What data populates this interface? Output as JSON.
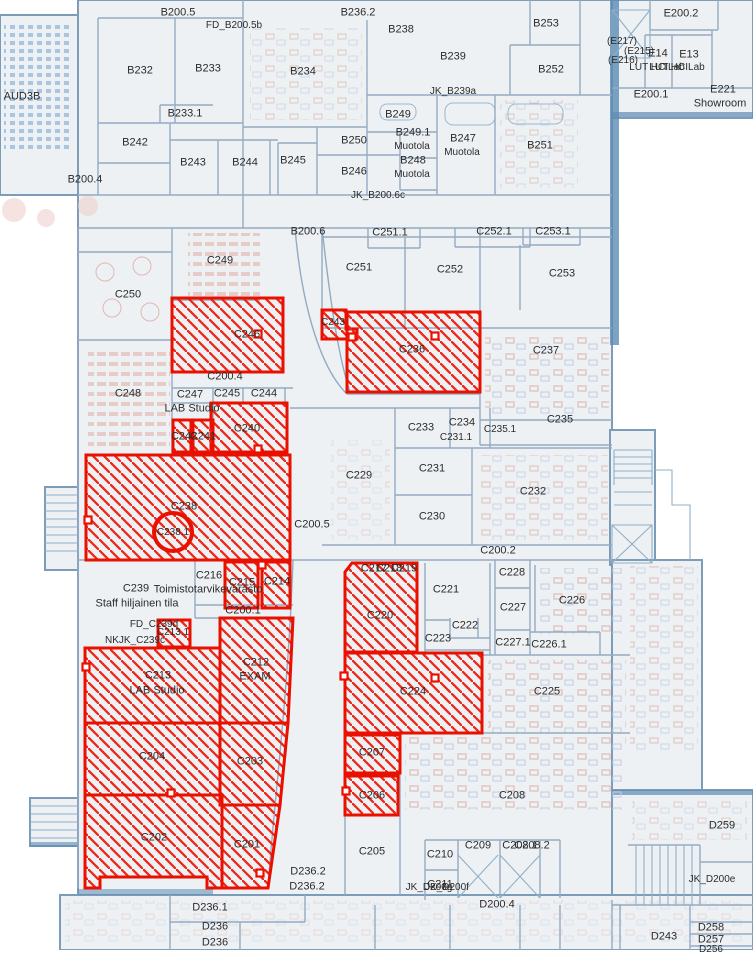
{
  "map": {
    "colors": {
      "highlight": "#ea1000",
      "wall": "#7d9cb8",
      "floor": "#eef1f4",
      "furniture": "#d9b4ae"
    },
    "labels": [
      {
        "t": "B200.5",
        "x": 178,
        "y": 13
      },
      {
        "t": "FD_B200.5b",
        "x": 234,
        "y": 26,
        "s": 10
      },
      {
        "t": "B236.2",
        "x": 358,
        "y": 13
      },
      {
        "t": "E200.2",
        "x": 681,
        "y": 14
      },
      {
        "t": "B232",
        "x": 140,
        "y": 71
      },
      {
        "t": "B233",
        "x": 208,
        "y": 69
      },
      {
        "t": "B234",
        "x": 303,
        "y": 72
      },
      {
        "t": "B238",
        "x": 401,
        "y": 30
      },
      {
        "t": "B239",
        "x": 453,
        "y": 57
      },
      {
        "t": "B253",
        "x": 546,
        "y": 24
      },
      {
        "t": "(E217)",
        "x": 622,
        "y": 42,
        "s": 10
      },
      {
        "t": "(E215)",
        "x": 639,
        "y": 52,
        "s": 10
      },
      {
        "t": "E14",
        "x": 658,
        "y": 54
      },
      {
        "t": "E13",
        "x": 689,
        "y": 55
      },
      {
        "t": "(E216)",
        "x": 623,
        "y": 61,
        "s": 10
      },
      {
        "t": "LUT HCILab",
        "x": 657,
        "y": 68,
        "s": 10
      },
      {
        "t": "LUT HCILab",
        "x": 677,
        "y": 68,
        "s": 10
      },
      {
        "t": "AUD3B",
        "x": 22,
        "y": 97
      },
      {
        "t": "JK_B239a",
        "x": 453,
        "y": 92,
        "s": 10
      },
      {
        "t": "B249",
        "x": 398,
        "y": 115
      },
      {
        "t": "E200.1",
        "x": 651,
        "y": 95
      },
      {
        "t": "E221",
        "x": 723,
        "y": 90
      },
      {
        "t": "Showroom",
        "x": 720,
        "y": 104
      },
      {
        "t": "B233.1",
        "x": 185,
        "y": 114
      },
      {
        "t": "B249.1",
        "x": 413,
        "y": 133
      },
      {
        "t": "Muotola",
        "x": 412,
        "y": 147,
        "s": 10
      },
      {
        "t": "B247",
        "x": 463,
        "y": 139
      },
      {
        "t": "Muotola",
        "x": 462,
        "y": 153,
        "s": 10
      },
      {
        "t": "B252",
        "x": 551,
        "y": 70
      },
      {
        "t": "B242",
        "x": 135,
        "y": 143
      },
      {
        "t": "B250",
        "x": 354,
        "y": 141
      },
      {
        "t": "B251",
        "x": 540,
        "y": 146
      },
      {
        "t": "B243",
        "x": 193,
        "y": 163
      },
      {
        "t": "B244",
        "x": 245,
        "y": 163
      },
      {
        "t": "B245",
        "x": 293,
        "y": 161
      },
      {
        "t": "B248",
        "x": 413,
        "y": 161
      },
      {
        "t": "Muotola",
        "x": 412,
        "y": 175,
        "s": 10
      },
      {
        "t": "B246",
        "x": 354,
        "y": 172
      },
      {
        "t": "B200.4",
        "x": 85,
        "y": 180
      },
      {
        "t": "JK_B200.6c",
        "x": 378,
        "y": 196,
        "s": 10
      },
      {
        "t": "B200.6",
        "x": 308,
        "y": 232
      },
      {
        "t": "C251.1",
        "x": 390,
        "y": 233
      },
      {
        "t": "C252.1",
        "x": 494,
        "y": 232
      },
      {
        "t": "C253.1",
        "x": 553,
        "y": 232
      },
      {
        "t": "C249",
        "x": 220,
        "y": 261
      },
      {
        "t": "C251",
        "x": 359,
        "y": 268
      },
      {
        "t": "C252",
        "x": 450,
        "y": 270
      },
      {
        "t": "C253",
        "x": 562,
        "y": 274
      },
      {
        "t": "C250",
        "x": 128,
        "y": 295
      },
      {
        "t": "C243",
        "x": 333,
        "y": 323,
        "s": 10
      },
      {
        "t": "C246",
        "x": 247,
        "y": 335
      },
      {
        "t": "C236",
        "x": 412,
        "y": 350
      },
      {
        "t": "C237",
        "x": 546,
        "y": 351
      },
      {
        "t": "C200.4",
        "x": 225,
        "y": 377
      },
      {
        "t": "C248",
        "x": 128,
        "y": 394
      },
      {
        "t": "C247",
        "x": 190,
        "y": 395
      },
      {
        "t": "C245",
        "x": 227,
        "y": 394
      },
      {
        "t": "C244",
        "x": 264,
        "y": 394
      },
      {
        "t": "LAB Studio",
        "x": 192,
        "y": 409
      },
      {
        "t": "C240",
        "x": 247,
        "y": 429
      },
      {
        "t": "C242",
        "x": 184,
        "y": 437
      },
      {
        "t": "C241",
        "x": 203,
        "y": 437
      },
      {
        "t": "C233",
        "x": 421,
        "y": 428
      },
      {
        "t": "C234",
        "x": 462,
        "y": 423
      },
      {
        "t": "C231.1",
        "x": 456,
        "y": 438,
        "s": 10
      },
      {
        "t": "C235.1",
        "x": 500,
        "y": 430,
        "s": 10
      },
      {
        "t": "C235",
        "x": 560,
        "y": 420
      },
      {
        "t": "C229",
        "x": 359,
        "y": 476
      },
      {
        "t": "C231",
        "x": 432,
        "y": 469
      },
      {
        "t": "C232",
        "x": 533,
        "y": 492
      },
      {
        "t": "C230",
        "x": 432,
        "y": 517
      },
      {
        "t": "C238",
        "x": 184,
        "y": 507
      },
      {
        "t": "C238.1",
        "x": 173,
        "y": 533,
        "s": 10
      },
      {
        "t": "C200.5",
        "x": 312,
        "y": 525
      },
      {
        "t": "C200.2",
        "x": 498,
        "y": 551
      },
      {
        "t": "C216",
        "x": 209,
        "y": 576
      },
      {
        "t": "C215",
        "x": 242,
        "y": 583
      },
      {
        "t": "C214",
        "x": 277,
        "y": 582
      },
      {
        "t": "C217",
        "x": 374,
        "y": 569
      },
      {
        "t": "C218",
        "x": 389,
        "y": 569
      },
      {
        "t": "C219",
        "x": 404,
        "y": 569
      },
      {
        "t": "C220",
        "x": 380,
        "y": 616
      },
      {
        "t": "C221",
        "x": 446,
        "y": 590
      },
      {
        "t": "C228",
        "x": 512,
        "y": 573
      },
      {
        "t": "C227",
        "x": 513,
        "y": 608
      },
      {
        "t": "C226",
        "x": 572,
        "y": 601
      },
      {
        "t": "C239",
        "x": 136,
        "y": 589
      },
      {
        "t": "Toimistotarvikevarasto",
        "x": 208,
        "y": 590
      },
      {
        "t": "Staff hiljainen tila",
        "x": 137,
        "y": 604
      },
      {
        "t": "C222",
        "x": 465,
        "y": 626
      },
      {
        "t": "C223",
        "x": 438,
        "y": 639
      },
      {
        "t": "C227.1",
        "x": 513,
        "y": 643
      },
      {
        "t": "C226.1",
        "x": 549,
        "y": 645
      },
      {
        "t": "C200.1",
        "x": 243,
        "y": 611
      },
      {
        "t": "FD_C239d",
        "x": 154,
        "y": 625,
        "s": 10
      },
      {
        "t": "C213.1",
        "x": 173,
        "y": 633,
        "s": 10
      },
      {
        "t": "NKJK_C239c",
        "x": 135,
        "y": 641,
        "s": 10
      },
      {
        "t": "C212",
        "x": 256,
        "y": 663
      },
      {
        "t": "EXAM",
        "x": 255,
        "y": 677
      },
      {
        "t": "C213",
        "x": 158,
        "y": 676
      },
      {
        "t": "LAB Studio",
        "x": 157,
        "y": 691
      },
      {
        "t": "C224",
        "x": 413,
        "y": 692
      },
      {
        "t": "C225",
        "x": 547,
        "y": 692
      },
      {
        "t": "C204",
        "x": 152,
        "y": 757
      },
      {
        "t": "C203",
        "x": 250,
        "y": 762
      },
      {
        "t": "C207",
        "x": 372,
        "y": 753
      },
      {
        "t": "C206",
        "x": 372,
        "y": 796
      },
      {
        "t": "C208",
        "x": 512,
        "y": 796
      },
      {
        "t": "C202",
        "x": 154,
        "y": 838
      },
      {
        "t": "C201",
        "x": 247,
        "y": 845
      },
      {
        "t": "C205",
        "x": 372,
        "y": 852
      },
      {
        "t": "C210",
        "x": 440,
        "y": 855
      },
      {
        "t": "C211",
        "x": 440,
        "y": 885
      },
      {
        "t": "C209",
        "x": 478,
        "y": 846
      },
      {
        "t": "C208.1",
        "x": 520,
        "y": 846
      },
      {
        "t": "C208.2",
        "x": 532,
        "y": 846
      },
      {
        "t": "D236.2",
        "x": 308,
        "y": 872
      },
      {
        "t": "D236.2",
        "x": 307,
        "y": 887
      },
      {
        "t": "D236.1",
        "x": 210,
        "y": 908
      },
      {
        "t": "D236",
        "x": 215,
        "y": 927
      },
      {
        "t": "D236",
        "x": 215,
        "y": 943
      },
      {
        "t": "JK_D200g",
        "x": 429,
        "y": 888,
        "s": 10
      },
      {
        "t": "JK_D200f",
        "x": 447,
        "y": 888,
        "s": 10
      },
      {
        "t": "D200.4",
        "x": 497,
        "y": 905
      },
      {
        "t": "D259",
        "x": 722,
        "y": 826
      },
      {
        "t": "JK_D200e",
        "x": 712,
        "y": 880,
        "s": 10
      },
      {
        "t": "D243",
        "x": 664,
        "y": 937
      },
      {
        "t": "D258",
        "x": 711,
        "y": 928
      },
      {
        "t": "D257",
        "x": 711,
        "y": 940
      },
      {
        "t": "D256",
        "x": 711,
        "y": 950,
        "s": 10
      }
    ],
    "highlighted_rooms": [
      {
        "name": "C246",
        "pts": "172,298 283,298 283,372 172,372"
      },
      {
        "name": "C243",
        "pts": "322,310 346,310 346,329 357,329 357,339 322,339"
      },
      {
        "name": "C236",
        "pts": "347,312 480,312 480,392 347,392"
      },
      {
        "name": "C240",
        "pts": "211,403 287,403 287,452 211,452"
      },
      {
        "name": "C242",
        "pts": "173,420 191,420 191,452 173,452"
      },
      {
        "name": "C241",
        "pts": "193,420 213,420 213,452 193,452"
      },
      {
        "name": "C238",
        "pts": "86,455 290,455 290,560 86,560"
      },
      {
        "name": "C238.1",
        "circle": {
          "cx": 173,
          "cy": 532,
          "r": 19
        }
      },
      {
        "name": "C215",
        "pts": "225,562 258,562 258,608 225,608"
      },
      {
        "name": "C214",
        "pts": "262,562 290,562 290,608 262,608"
      },
      {
        "name": "C213.1",
        "pts": "158,620 190,620 190,647 158,647"
      },
      {
        "name": "C212",
        "pts": "220,618 293,618 288,723 220,723"
      },
      {
        "name": "C213",
        "pts": "85,648 220,648 220,723 85,723"
      },
      {
        "name": "C204",
        "pts": "85,723 220,723 220,795 85,795"
      },
      {
        "name": "C203",
        "pts": "220,723 288,723 280,805 220,805"
      },
      {
        "name": "C202",
        "pts": "85,795 222,795 222,888 207,888 207,877 100,877 100,888 85,888"
      },
      {
        "name": "C201",
        "pts": "222,805 280,805 268,888 222,888"
      },
      {
        "name": "C220",
        "pts": "345,572 352,563 417,563 417,652 345,652"
      },
      {
        "name": "C224",
        "pts": "345,653 482,653 482,733 345,733"
      },
      {
        "name": "C207",
        "pts": "345,735 400,735 400,773 345,773"
      },
      {
        "name": "C206",
        "pts": "345,776 398,776 398,815 345,815"
      }
    ],
    "door_markers": [
      [
        258,
        334
      ],
      [
        352,
        337
      ],
      [
        435,
        336
      ],
      [
        258,
        449
      ],
      [
        262,
        565
      ],
      [
        88,
        520
      ],
      [
        86,
        667
      ],
      [
        171,
        793
      ],
      [
        260,
        873
      ],
      [
        344,
        676
      ],
      [
        435,
        678
      ],
      [
        346,
        791
      ]
    ]
  }
}
